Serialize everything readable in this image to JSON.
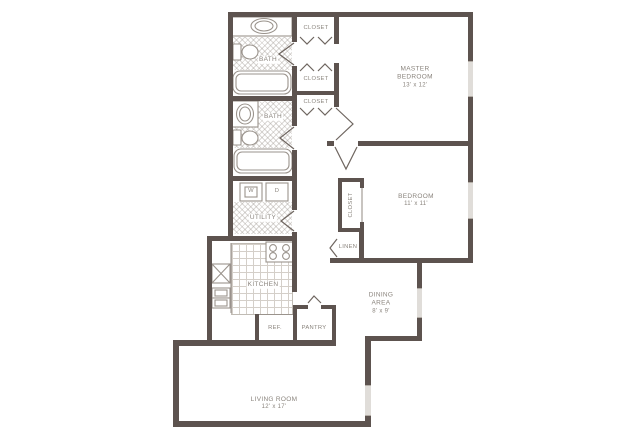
{
  "plan_title": "Two bedroom apartment floor plan",
  "rooms": {
    "master_bedroom": {
      "l1": "MASTER",
      "l2": "BEDROOM",
      "dims": "13' x 12'"
    },
    "bedroom": {
      "name": "BEDROOM",
      "dims": "11' x 11'"
    },
    "living_room": {
      "name": "LIVING ROOM",
      "dims": "12' x 17'"
    },
    "dining_area": {
      "l1": "DINING",
      "l2": "AREA",
      "dims": "8' x 9'"
    },
    "kitchen": {
      "name": "KITCHEN"
    },
    "utility": {
      "name": "UTILITY"
    },
    "bath_upper": {
      "name": "BATH"
    },
    "bath_lower": {
      "name": "BATH"
    },
    "closet_master_1": {
      "name": "CLOSET"
    },
    "closet_master_2": {
      "name": "CLOSET"
    },
    "closet_hall": {
      "name": "CLOSET"
    },
    "closet_bedroom": {
      "name": "CLOSET"
    },
    "linen": {
      "name": "LINEN"
    },
    "pantry": {
      "name": "PANTRY"
    },
    "ref": {
      "name": "REF."
    },
    "washer": {
      "name": "W"
    },
    "dryer": {
      "name": "D"
    }
  },
  "colors": {
    "wall": "#5d534f",
    "line": "#9a938c",
    "door": "#6e655f",
    "text": "#8a847d",
    "window": "#e0ddd9"
  }
}
